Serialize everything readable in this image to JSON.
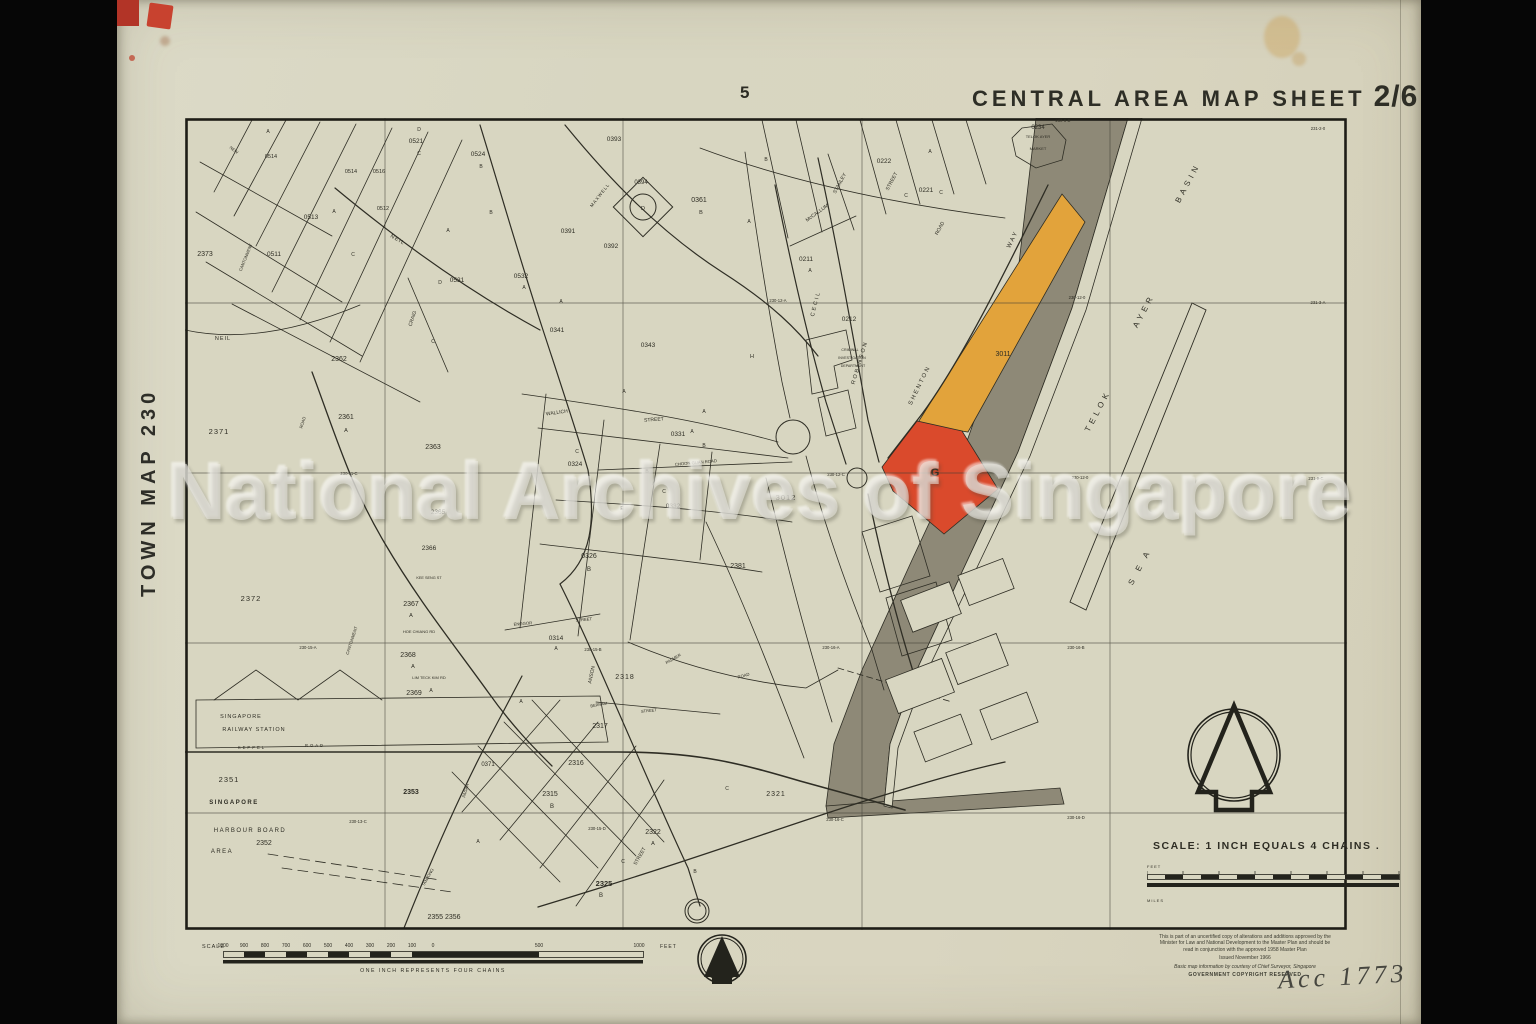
{
  "page_number": "5",
  "title": {
    "main": "CENTRAL AREA MAP SHEET",
    "sheet": "2/6"
  },
  "side_label": "TOWN MAP 230",
  "watermark": "National Archives of Singapore",
  "annotation": "Acc 1773",
  "colors": {
    "paper": "#d8d6c1",
    "ink": "#2e2d24",
    "highlight_red": "#da4a2c",
    "highlight_orange": "#e2a33b",
    "reclamation_gray": "#8e8977"
  },
  "scale_right": {
    "heading": "SCALE: 1 INCH EQUALS 4 CHAINS .",
    "feet": "FEET",
    "miles": "MILES"
  },
  "scale_bottom": {
    "label": "SCALE",
    "ticks": [
      "1000",
      "900",
      "800",
      "700",
      "600",
      "500",
      "400",
      "300",
      "200",
      "100",
      "0",
      "500",
      "1000"
    ],
    "unit": "FEET",
    "caption": "ONE INCH REPRESENTS FOUR CHAINS"
  },
  "notes": {
    "lines": [
      "This is part of an uncertified copy of alterations and additions approved by the",
      "Minister for Law and National Development to the Master Plan and should be",
      "read in conjunction with the approved 1958 Master Plan"
    ],
    "issued": "Issued November 1966",
    "courtesy": "Basic map information by courtesy of Chief Surveyor, Singapore",
    "copyright": "GOVERNMENT COPYRIGHT RESERVED"
  },
  "map": {
    "labels": [
      {
        "t": "0234",
        "x": 1038,
        "y": 129,
        "s": 6
      },
      {
        "t": "TELOK AYER",
        "x": 1038,
        "y": 138,
        "s": 4
      },
      {
        "t": "MARKET",
        "x": 1038,
        "y": 150,
        "s": 4
      },
      {
        "t": "230-6-D",
        "x": 1063,
        "y": 122,
        "s": 4.2
      },
      {
        "t": "BASIN",
        "x": 1190,
        "y": 184,
        "r": -62,
        "s": 8,
        "ls": 4
      },
      {
        "t": "AYER",
        "x": 1146,
        "y": 312,
        "r": -62,
        "s": 8,
        "ls": 4
      },
      {
        "t": "TELOK",
        "x": 1100,
        "y": 412,
        "r": -62,
        "s": 8,
        "ls": 4
      },
      {
        "t": "S E A",
        "x": 1142,
        "y": 568,
        "r": -62,
        "s": 8,
        "ls": 4
      },
      {
        "t": "3011",
        "x": 1003,
        "y": 356,
        "s": 7
      },
      {
        "t": "G",
        "x": 935,
        "y": 476,
        "s": 11,
        "b": 1
      },
      {
        "t": "3012",
        "x": 786,
        "y": 500,
        "s": 7.5,
        "ls": 1
      },
      {
        "t": "2381",
        "x": 738,
        "y": 568,
        "s": 7
      },
      {
        "t": "SHENTON",
        "x": 921,
        "y": 386,
        "r": -64,
        "s": 6,
        "ls": 2
      },
      {
        "t": "WAY",
        "x": 1014,
        "y": 240,
        "r": -64,
        "s": 6,
        "ls": 2
      },
      {
        "t": "ROBINSON",
        "x": 861,
        "y": 363,
        "r": -73,
        "s": 5.5,
        "ls": 2
      },
      {
        "t": "CECIL",
        "x": 817,
        "y": 304,
        "r": -76,
        "s": 5.5,
        "ls": 2
      },
      {
        "t": "McCALLUM",
        "x": 818,
        "y": 214,
        "r": -36,
        "s": 5
      },
      {
        "t": "STANLEY",
        "x": 841,
        "y": 184,
        "r": -62,
        "s": 5
      },
      {
        "t": "STREET",
        "x": 893,
        "y": 182,
        "r": -62,
        "s": 5
      },
      {
        "t": "ROAD",
        "x": 941,
        "y": 229,
        "r": -62,
        "s": 5
      },
      {
        "t": "0222",
        "x": 884,
        "y": 163,
        "s": 6.5
      },
      {
        "t": "0221",
        "x": 926,
        "y": 192,
        "s": 6.5
      },
      {
        "t": "C",
        "x": 941,
        "y": 194,
        "s": 5
      },
      {
        "t": "0211",
        "x": 806,
        "y": 261,
        "s": 6.5
      },
      {
        "t": "A",
        "x": 810,
        "y": 272,
        "s": 5
      },
      {
        "t": "0212",
        "x": 849,
        "y": 321,
        "s": 6.5
      },
      {
        "t": "CRIMINAL",
        "x": 850,
        "y": 351,
        "s": 3.6
      },
      {
        "t": "INVESTIGATION",
        "x": 852,
        "y": 359,
        "s": 3.6
      },
      {
        "t": "DEPARTMENT",
        "x": 853,
        "y": 367,
        "s": 3.6
      },
      {
        "t": "H",
        "x": 752,
        "y": 358,
        "s": 5.5
      },
      {
        "t": "0361",
        "x": 699,
        "y": 202,
        "s": 7
      },
      {
        "t": "B",
        "x": 701,
        "y": 214,
        "s": 5.5
      },
      {
        "t": "0394",
        "x": 641,
        "y": 184,
        "s": 6
      },
      {
        "t": "D",
        "x": 643,
        "y": 210,
        "s": 5.5
      },
      {
        "t": "0393",
        "x": 614,
        "y": 141,
        "s": 6.5
      },
      {
        "t": "0391",
        "x": 568,
        "y": 233,
        "s": 6.5
      },
      {
        "t": "0392",
        "x": 611,
        "y": 248,
        "s": 6.5
      },
      {
        "t": "MAXWELL",
        "x": 601,
        "y": 196,
        "r": -52,
        "s": 4.5,
        "ls": 1
      },
      {
        "t": "0341",
        "x": 557,
        "y": 332,
        "s": 6.5
      },
      {
        "t": "0343",
        "x": 648,
        "y": 347,
        "s": 6.5
      },
      {
        "t": "WALLICH",
        "x": 557,
        "y": 414,
        "r": -8,
        "s": 5
      },
      {
        "t": "STREET",
        "x": 654,
        "y": 421,
        "r": -4,
        "s": 5
      },
      {
        "t": "0331",
        "x": 678,
        "y": 436,
        "s": 6.5
      },
      {
        "t": "A",
        "x": 692,
        "y": 433,
        "s": 5
      },
      {
        "t": "CHOON GUAN ROAD",
        "x": 696,
        "y": 464,
        "r": -5,
        "s": 4.2
      },
      {
        "t": "0324",
        "x": 575,
        "y": 466,
        "s": 6.5
      },
      {
        "t": "0332",
        "x": 673,
        "y": 508,
        "s": 6.5
      },
      {
        "t": "E",
        "x": 622,
        "y": 510,
        "s": 5
      },
      {
        "t": "0326",
        "x": 589,
        "y": 558,
        "s": 7
      },
      {
        "t": "B",
        "x": 589,
        "y": 571,
        "s": 6
      },
      {
        "t": "0314",
        "x": 556,
        "y": 640,
        "s": 6.5
      },
      {
        "t": "A",
        "x": 556,
        "y": 650,
        "s": 5
      },
      {
        "t": "ENGGOR",
        "x": 523,
        "y": 625,
        "r": -5,
        "s": 4.2
      },
      {
        "t": "STREET",
        "x": 584,
        "y": 621,
        "r": -5,
        "s": 4.2
      },
      {
        "t": "ANSON",
        "x": 593,
        "y": 675,
        "r": -78,
        "s": 5
      },
      {
        "t": "2318",
        "x": 625,
        "y": 679,
        "s": 7,
        "ls": 1
      },
      {
        "t": "PALMER",
        "x": 674,
        "y": 660,
        "r": -30,
        "s": 4.2
      },
      {
        "t": "ROAD",
        "x": 744,
        "y": 677,
        "r": -16,
        "s": 4.2
      },
      {
        "t": "BERNAM",
        "x": 599,
        "y": 706,
        "r": -10,
        "s": 4
      },
      {
        "t": "STREET",
        "x": 649,
        "y": 712,
        "r": -6,
        "s": 4
      },
      {
        "t": "2317",
        "x": 600,
        "y": 728,
        "s": 7
      },
      {
        "t": "2316",
        "x": 576,
        "y": 765,
        "s": 7
      },
      {
        "t": "2315",
        "x": 550,
        "y": 796,
        "s": 7
      },
      {
        "t": "B",
        "x": 552,
        "y": 808,
        "s": 6
      },
      {
        "t": "2322",
        "x": 653,
        "y": 834,
        "s": 7
      },
      {
        "t": "A",
        "x": 653,
        "y": 845,
        "s": 5.5
      },
      {
        "t": "2321",
        "x": 776,
        "y": 796,
        "s": 7,
        "ls": 1
      },
      {
        "t": "2325",
        "x": 604,
        "y": 886,
        "s": 7.5,
        "b": 1
      },
      {
        "t": "B",
        "x": 601,
        "y": 897,
        "s": 6
      },
      {
        "t": "2355 2356",
        "x": 444,
        "y": 919,
        "s": 7
      },
      {
        "t": "STREET",
        "x": 641,
        "y": 857,
        "r": -60,
        "s": 5
      },
      {
        "t": "TANJONG",
        "x": 429,
        "y": 878,
        "r": -60,
        "s": 4.2
      },
      {
        "t": "PAGAR",
        "x": 467,
        "y": 791,
        "r": -74,
        "s": 4.2
      },
      {
        "t": "0371",
        "x": 488,
        "y": 766,
        "s": 6
      },
      {
        "t": "2371",
        "x": 219,
        "y": 434,
        "s": 7.5,
        "ls": 1
      },
      {
        "t": "2361",
        "x": 346,
        "y": 419,
        "s": 7
      },
      {
        "t": "A",
        "x": 346,
        "y": 432,
        "s": 5.5
      },
      {
        "t": "2362",
        "x": 339,
        "y": 361,
        "s": 7
      },
      {
        "t": "2363",
        "x": 433,
        "y": 449,
        "s": 7
      },
      {
        "t": "2365",
        "x": 438,
        "y": 514,
        "s": 6.5
      },
      {
        "t": "2366",
        "x": 429,
        "y": 550,
        "s": 6.5
      },
      {
        "t": "2367",
        "x": 411,
        "y": 606,
        "s": 7
      },
      {
        "t": "A",
        "x": 411,
        "y": 617,
        "s": 5.5
      },
      {
        "t": "2368",
        "x": 408,
        "y": 657,
        "s": 7
      },
      {
        "t": "A",
        "x": 413,
        "y": 668,
        "s": 5.5
      },
      {
        "t": "2369",
        "x": 414,
        "y": 695,
        "s": 7
      },
      {
        "t": "A",
        "x": 431,
        "y": 692,
        "s": 5
      },
      {
        "t": "2372",
        "x": 251,
        "y": 601,
        "s": 7.5,
        "ls": 1
      },
      {
        "t": "2373",
        "x": 205,
        "y": 256,
        "s": 7
      },
      {
        "t": "HOE CHIANG RD",
        "x": 419,
        "y": 633,
        "s": 4
      },
      {
        "t": "LIM TECK KIM RD",
        "x": 429,
        "y": 679,
        "s": 4
      },
      {
        "t": "KEE SENG ST",
        "x": 429,
        "y": 579,
        "s": 3.8
      },
      {
        "t": "CANTONMENT",
        "x": 353,
        "y": 641,
        "r": -72,
        "s": 4.2
      },
      {
        "t": "CANTONMENT",
        "x": 247,
        "y": 258,
        "r": -68,
        "s": 4.2
      },
      {
        "t": "ROAD",
        "x": 304,
        "y": 423,
        "r": -72,
        "s": 4.2
      },
      {
        "t": "NEIL",
        "x": 397,
        "y": 241,
        "r": 30,
        "s": 5.5,
        "ls": 1
      },
      {
        "t": "NEIL",
        "x": 223,
        "y": 340,
        "s": 5.5,
        "ls": 1
      },
      {
        "t": "CRAIG",
        "x": 414,
        "y": 319,
        "r": -72,
        "s": 5
      },
      {
        "t": "NEW",
        "x": 233,
        "y": 151,
        "r": 38,
        "s": 4.2
      },
      {
        "t": "0514",
        "x": 271,
        "y": 158,
        "s": 5.5
      },
      {
        "t": "0514",
        "x": 351,
        "y": 173,
        "s": 5.5
      },
      {
        "t": "0516",
        "x": 379,
        "y": 173,
        "s": 5.5
      },
      {
        "t": "0521",
        "x": 416,
        "y": 143,
        "s": 6.5
      },
      {
        "t": "C",
        "x": 419,
        "y": 155,
        "s": 5
      },
      {
        "t": "0524",
        "x": 478,
        "y": 156,
        "s": 6.5
      },
      {
        "t": "B",
        "x": 481,
        "y": 168,
        "s": 5
      },
      {
        "t": "0513",
        "x": 311,
        "y": 219,
        "s": 6.5
      },
      {
        "t": "0511",
        "x": 274,
        "y": 256,
        "s": 6.5
      },
      {
        "t": "0512",
        "x": 383,
        "y": 210,
        "s": 5.5
      },
      {
        "t": "0532",
        "x": 521,
        "y": 278,
        "s": 6.5
      },
      {
        "t": "A",
        "x": 524,
        "y": 289,
        "s": 5
      },
      {
        "t": "0531",
        "x": 457,
        "y": 282,
        "s": 6.5
      },
      {
        "t": "D",
        "x": 440,
        "y": 284,
        "s": 5
      },
      {
        "t": "2351",
        "x": 229,
        "y": 782,
        "s": 7.5,
        "ls": 1
      },
      {
        "t": "SINGAPORE",
        "x": 234,
        "y": 804,
        "s": 6,
        "ls": 1.5,
        "b": 1
      },
      {
        "t": "HARBOUR BOARD",
        "x": 250,
        "y": 832,
        "s": 6,
        "ls": 1.5
      },
      {
        "t": "2352",
        "x": 264,
        "y": 845,
        "s": 7
      },
      {
        "t": "AREA",
        "x": 222,
        "y": 853,
        "s": 6,
        "ls": 1.5
      },
      {
        "t": "2353",
        "x": 411,
        "y": 794,
        "s": 7,
        "b": 1
      },
      {
        "t": "SINGAPORE",
        "x": 241,
        "y": 718,
        "s": 5.5,
        "ls": 1
      },
      {
        "t": "RAILWAY STATION",
        "x": 254,
        "y": 731,
        "s": 5.5,
        "ls": 1
      },
      {
        "t": "KEPPEL",
        "x": 252,
        "y": 749,
        "s": 4.2,
        "ls": 2
      },
      {
        "t": "ROAD",
        "x": 315,
        "y": 747,
        "s": 4.2,
        "ls": 2
      },
      {
        "t": "230-12-A",
        "x": 778,
        "y": 302,
        "s": 4.2
      },
      {
        "t": "230-12-0",
        "x": 1077,
        "y": 299,
        "s": 4.2
      },
      {
        "t": "230-12-0",
        "x": 1080,
        "y": 479,
        "s": 4.2
      },
      {
        "t": "230-12-C",
        "x": 836,
        "y": 476,
        "s": 4.2
      },
      {
        "t": "231-2-0",
        "x": 1318,
        "y": 130,
        "s": 4.2
      },
      {
        "t": "231-3-A",
        "x": 1318,
        "y": 304,
        "s": 4.2
      },
      {
        "t": "231-9-C",
        "x": 1316,
        "y": 480,
        "s": 4.2
      },
      {
        "t": "230-16-A",
        "x": 831,
        "y": 649,
        "s": 4.2
      },
      {
        "t": "230-16-B",
        "x": 1076,
        "y": 649,
        "s": 4.2
      },
      {
        "t": "230-16-C",
        "x": 835,
        "y": 821,
        "s": 4.2
      },
      {
        "t": "230-16-D",
        "x": 1076,
        "y": 819,
        "s": 4.2
      },
      {
        "t": "230-13-C",
        "x": 358,
        "y": 823,
        "s": 4.2
      },
      {
        "t": "230-15-A",
        "x": 308,
        "y": 649,
        "s": 4.2
      },
      {
        "t": "230-15-B",
        "x": 593,
        "y": 651,
        "s": 4.2
      },
      {
        "t": "230-15-D",
        "x": 597,
        "y": 830,
        "s": 4.2
      },
      {
        "t": "230-11-C",
        "x": 349,
        "y": 475,
        "s": 4.2
      },
      {
        "t": "A",
        "x": 268,
        "y": 133,
        "s": 5
      },
      {
        "t": "A",
        "x": 334,
        "y": 213,
        "s": 5
      },
      {
        "t": "A",
        "x": 448,
        "y": 232,
        "s": 5
      },
      {
        "t": "A",
        "x": 561,
        "y": 303,
        "s": 5
      },
      {
        "t": "A",
        "x": 624,
        "y": 393,
        "s": 5
      },
      {
        "t": "A",
        "x": 704,
        "y": 413,
        "s": 5
      },
      {
        "t": "A",
        "x": 749,
        "y": 223,
        "s": 5
      },
      {
        "t": "A",
        "x": 930,
        "y": 153,
        "s": 5
      },
      {
        "t": "A",
        "x": 521,
        "y": 703,
        "s": 5
      },
      {
        "t": "A",
        "x": 478,
        "y": 843,
        "s": 5
      },
      {
        "t": "B",
        "x": 491,
        "y": 214,
        "s": 5
      },
      {
        "t": "B",
        "x": 704,
        "y": 447,
        "s": 5
      },
      {
        "t": "B",
        "x": 647,
        "y": 473,
        "s": 5
      },
      {
        "t": "B",
        "x": 766,
        "y": 161,
        "s": 5
      },
      {
        "t": "B",
        "x": 695,
        "y": 873,
        "s": 5
      },
      {
        "t": "C",
        "x": 353,
        "y": 256,
        "s": 5
      },
      {
        "t": "C",
        "x": 433,
        "y": 343,
        "s": 5
      },
      {
        "t": "C",
        "x": 577,
        "y": 453,
        "s": 5
      },
      {
        "t": "C",
        "x": 664,
        "y": 493,
        "s": 5
      },
      {
        "t": "C",
        "x": 623,
        "y": 863,
        "s": 5
      },
      {
        "t": "C",
        "x": 906,
        "y": 197,
        "s": 5
      },
      {
        "t": "C",
        "x": 727,
        "y": 790,
        "s": 5
      },
      {
        "t": "D",
        "x": 419,
        "y": 131,
        "s": 5
      }
    ]
  }
}
